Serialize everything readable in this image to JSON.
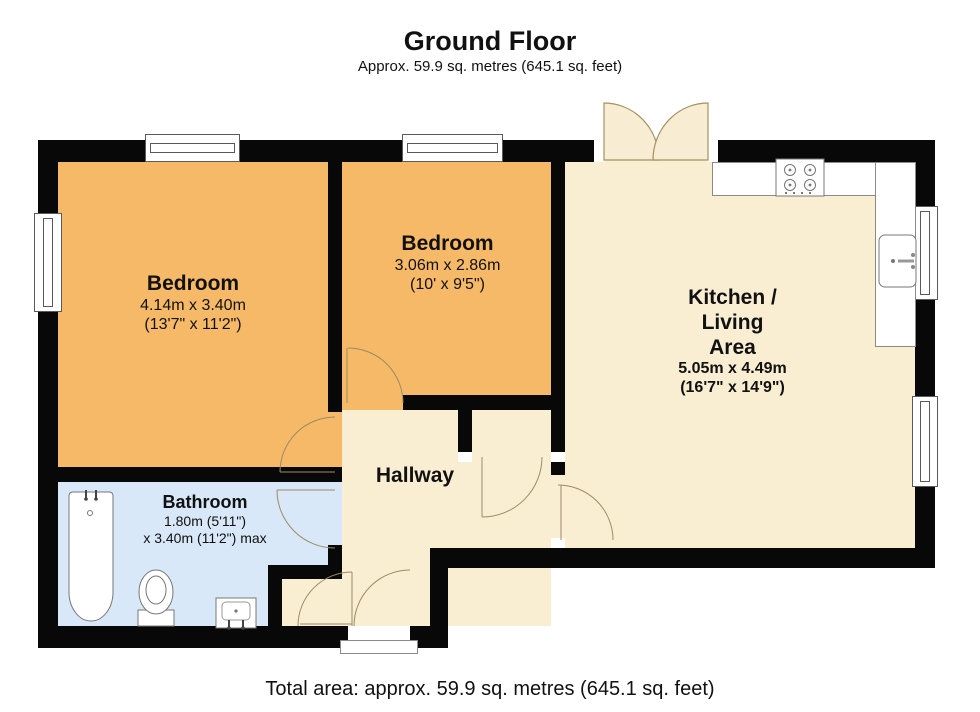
{
  "header": {
    "title": "Ground Floor",
    "subtitle": "Approx. 59.9 sq. metres (645.1 sq. feet)"
  },
  "footer": {
    "total_area": "Total area: approx. 59.9 sq. metres (645.1 sq. feet)"
  },
  "rooms": {
    "bedroom1": {
      "name": "Bedroom",
      "dims_metric": "4.14m x 3.40m",
      "dims_imperial": "(13'7\" x 11'2\")"
    },
    "bedroom2": {
      "name": "Bedroom",
      "dims_metric": "3.06m x 2.86m",
      "dims_imperial": "(10' x 9'5\")"
    },
    "kitchen_living": {
      "name_line1": "Kitchen /",
      "name_line2": "Living",
      "name_line3": "Area",
      "dims_metric": "5.05m x 4.49m",
      "dims_imperial": "(16'7\" x 14'9\")"
    },
    "hallway": {
      "name": "Hallway"
    },
    "bathroom": {
      "name": "Bathroom",
      "dims_line1": "1.80m (5'11\")",
      "dims_line2": "x 3.40m (11'2\") max"
    }
  },
  "colors": {
    "bedroom_floor": "#f6b968",
    "living_floor": "#f9edd2",
    "bathroom_floor": "#d8e8f8",
    "wall": "#080808",
    "door_arc": "#9b8b66",
    "fixture_outline": "#777777"
  }
}
